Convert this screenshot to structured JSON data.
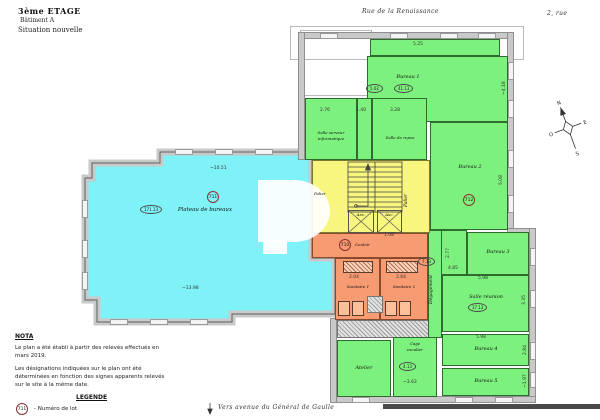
{
  "header": {
    "title": "3ème ETAGE",
    "building": "Bâtiment A",
    "status": "Situation nouvelle"
  },
  "streets": {
    "top": "Rue de la Renaissance",
    "top_right": "2, rue",
    "bottom": "Vers avenue du Général de Gaulle"
  },
  "compass": {
    "n": "N",
    "s": "S",
    "e": "E",
    "o": "O"
  },
  "rooms": {
    "plateau": {
      "label": "Plateau de bureaux",
      "tag": "711",
      "area": "171.13"
    },
    "bureau1": {
      "label": "Bureau 1",
      "dim_a": "5.02",
      "dim_b": "41.13"
    },
    "salle_serveur": {
      "line1": "Salle serveur",
      "line2": "informatique"
    },
    "salle_repos": {
      "label": "Salle de repos"
    },
    "bureau2": {
      "label": "Bureau 2",
      "tag": "712"
    },
    "bureau3": {
      "label": "Bureau 3"
    },
    "salle_reunion": {
      "label": "Salle réunion",
      "area": "17.13"
    },
    "bureau4": {
      "label": "Bureau 4"
    },
    "bureau5": {
      "label": "Bureau 5"
    },
    "atelier": {
      "label": "Atelier"
    },
    "cage_escalier": {
      "line1": "Cage",
      "line2": "escalier",
      "area": "4.13"
    },
    "degagement": {
      "label": "Dégagement",
      "area": "7.13"
    },
    "couloir": {
      "label": "Couloir",
      "tag": "710"
    },
    "sanitaire1": {
      "label": "Sanitaire 1"
    },
    "sanitaire2": {
      "label": "Sanitaire 2"
    },
    "palier_left": {
      "label": "Palier"
    },
    "palier_right": {
      "label": "Palier"
    },
    "ascenseur1": {
      "label": "Asc."
    },
    "ascenseur2": {
      "label": "Asc."
    }
  },
  "dims": {
    "d1": "5.25",
    "d2": "2.76",
    "d3": "1.40",
    "d4": "3.28",
    "d5": "~4.18",
    "d6": "5.08",
    "d7": "~10.51",
    "d8": "~13.98",
    "d9": "1.08",
    "d10": "2.77",
    "d11": "4.85",
    "d12": "5.98",
    "d13": "3.35",
    "d14": "5.98",
    "d15": "2.84",
    "d16": "~1.97",
    "d17": "~3.63",
    "d18": "2.04",
    "d19": "2.64"
  },
  "nota": {
    "heading": "NOTA",
    "p1": "Le plan a été établi à partir des relevés effectués en mars 2019.",
    "p2": "Les désignations indiquées sur le plan ont été déterminées en fonction des signes apparents relevés sur le site à la même date."
  },
  "legend": {
    "heading": "LEGENDE",
    "tag": "711",
    "desc": "- Numéro de lot"
  },
  "colors": {
    "cyan": "#7ef2f6",
    "green": "#7df17d",
    "yellow": "#f8f67e",
    "orange": "#f79b72",
    "wall": "#c9c9c9",
    "tag_ring": "#8a3030"
  }
}
